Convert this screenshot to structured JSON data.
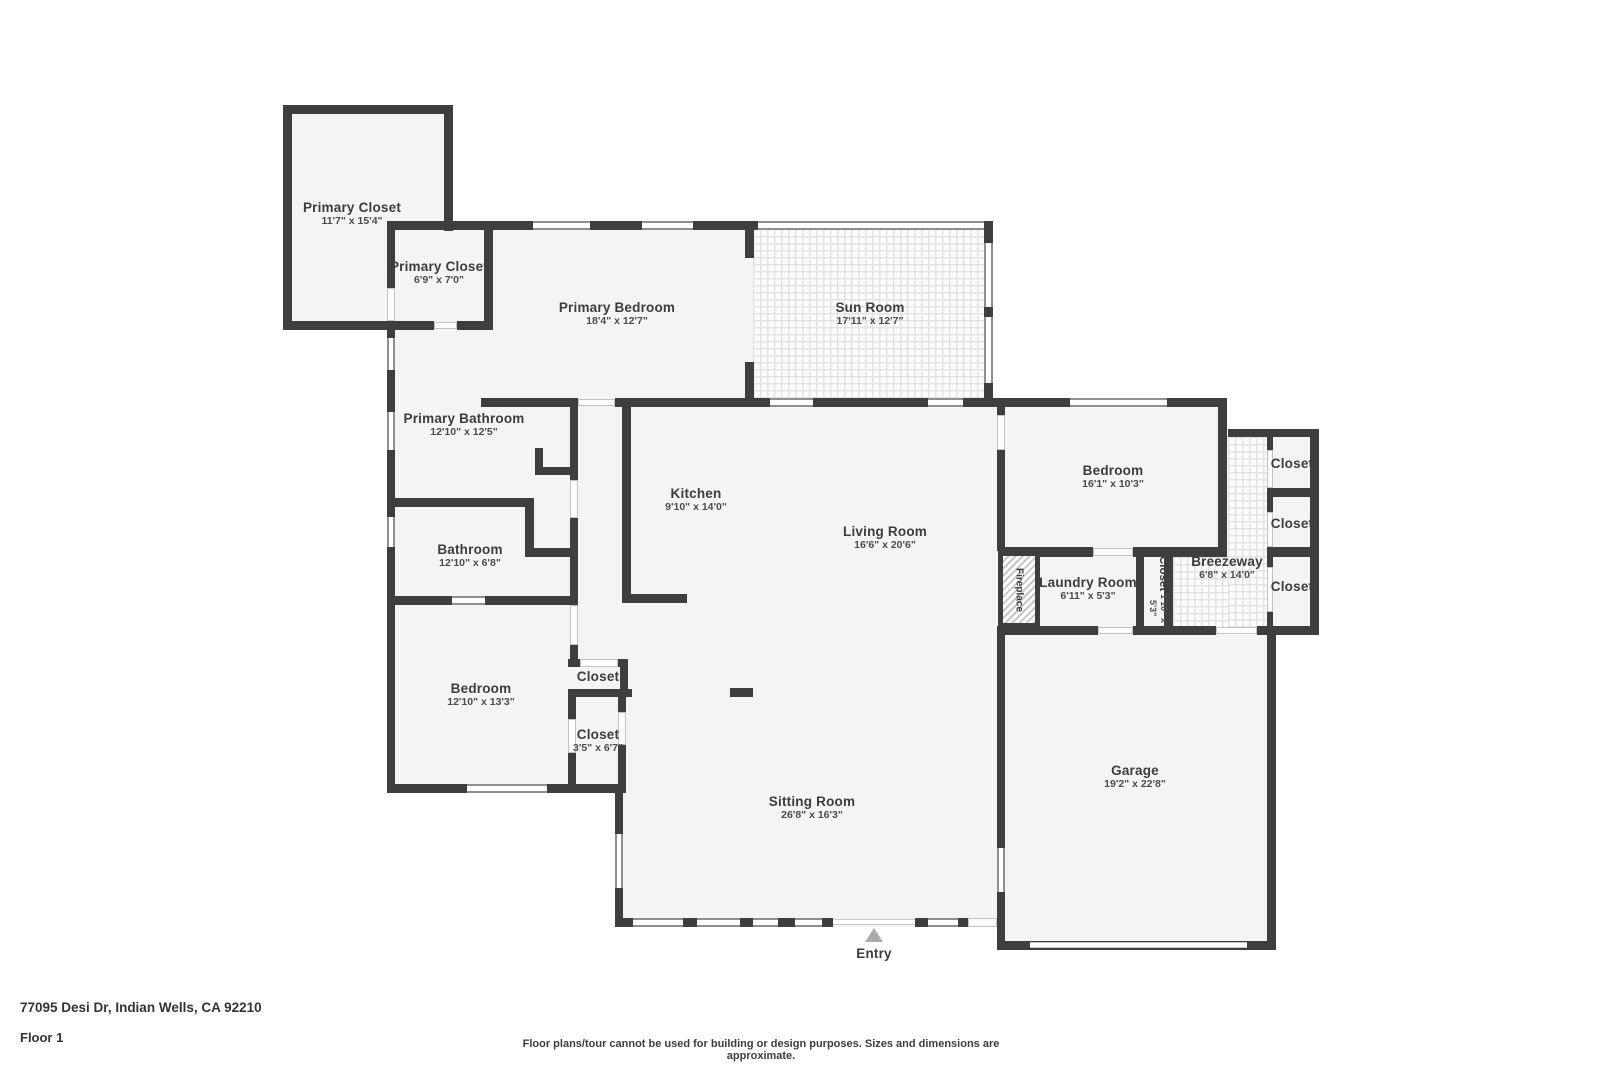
{
  "footer": {
    "address": "77095 Desi Dr, Indian Wells, CA 92210",
    "floor_label": "Floor 1",
    "disclaimer": "Floor plans/tour cannot be used for building or design purposes. Sizes and dimensions are approximate."
  },
  "entry": {
    "label": "Entry"
  },
  "rooms": [
    {
      "name": "Primary Closet",
      "dims": "11'7\" x 15'4\""
    },
    {
      "name": "Primary Closet",
      "dims": "6'9\" x 7'0\""
    },
    {
      "name": "Primary Bedroom",
      "dims": "18'4\" x 12'7\""
    },
    {
      "name": "Sun Room",
      "dims": "17'11\" x 12'7\""
    },
    {
      "name": "Primary Bathroom",
      "dims": "12'10\" x 12'5\""
    },
    {
      "name": "Kitchen",
      "dims": "9'10\" x 14'0\""
    },
    {
      "name": "Living Room",
      "dims": "16'6\" x 20'6\""
    },
    {
      "name": "Bedroom",
      "dims": "16'1\" x 10'3\""
    },
    {
      "name": "Bathroom",
      "dims": "12'10\" x 6'8\""
    },
    {
      "name": "Closet"
    },
    {
      "name": "Closet"
    },
    {
      "name": "Closet"
    },
    {
      "name": "Breezeway",
      "dims": "6'8\" x 14'0\""
    },
    {
      "name": "Laundry Room",
      "dims": "6'11\" x 5'3\""
    },
    {
      "name": "Closet",
      "dims": "1'10\" x 5'3\""
    },
    {
      "name": "Fireplace"
    },
    {
      "name": "Bedroom",
      "dims": "12'10\" x 13'3\""
    },
    {
      "name": "Closet"
    },
    {
      "name": "Closet",
      "dims": "3'5\" x 6'7\""
    },
    {
      "name": "Garage",
      "dims": "19'2\" x 22'8\""
    },
    {
      "name": "Sitting Room",
      "dims": "26'8\" x 16'3\""
    }
  ],
  "colors": {
    "wall": "#3e3e3e",
    "floor": "#f4f4f4",
    "entry_marker": "#ababab"
  }
}
